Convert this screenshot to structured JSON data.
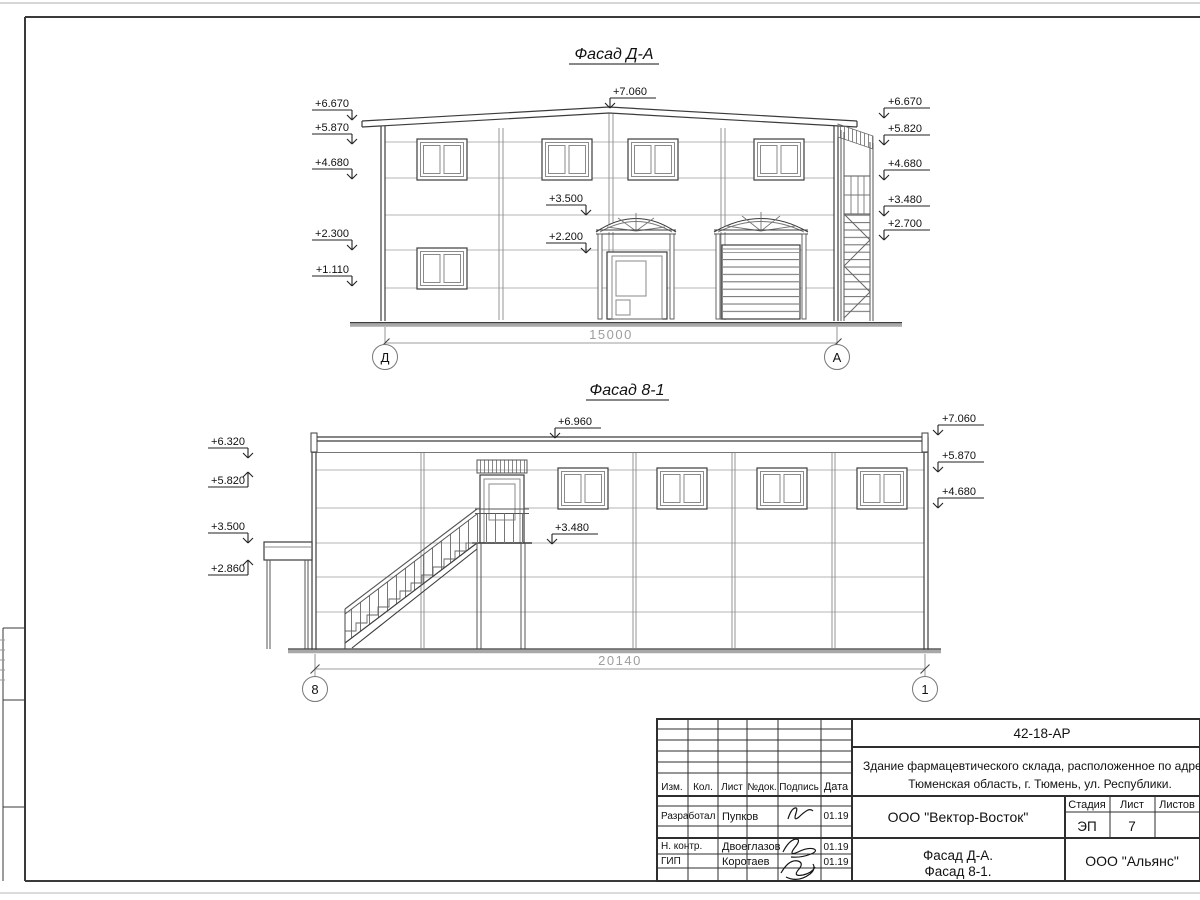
{
  "facade_da": {
    "title": "Фасад Д-А",
    "top_mark": "+7.060",
    "left_marks": [
      "+6.670",
      "+5.870",
      "+4.680",
      "+2.300",
      "+1.110"
    ],
    "mid_marks": [
      "+3.500",
      "+2.200"
    ],
    "right_marks": [
      "+6.670",
      "+5.820",
      "+4.680",
      "+3.480",
      "+2.700"
    ],
    "dimension": "15000",
    "axis_left": "Д",
    "axis_right": "А"
  },
  "facade_81": {
    "title": "Фасад 8-1",
    "top_mark": "+6.960",
    "left_marks": [
      "+6.320",
      "+5.820",
      "+3.500",
      "+2.860"
    ],
    "mid_marks": [
      "+3.480"
    ],
    "right_marks": [
      "+7.060",
      "+5.870",
      "+4.680"
    ],
    "dimension": "20140",
    "axis_left": "8",
    "axis_right": "1"
  },
  "title_block": {
    "doc_number": "42-18-АР",
    "address_line1": "Здание фармацевтического склада, расположенное по адресу:",
    "address_line2": "Тюменская область, г. Тюмень, ул. Республики.",
    "headers": [
      "Изм.",
      "Кол.",
      "Лист",
      "№док.",
      "Подпись",
      "Дата"
    ],
    "rows": [
      {
        "role": "Разработал",
        "name": "Пупков",
        "date": "01.19"
      },
      {
        "role": "Н. контр.",
        "name": "Двоеглазов",
        "date": "01.19"
      },
      {
        "role": "ГИП",
        "name": "Коротаев",
        "date": "01.19"
      }
    ],
    "design_company": "ООО \"Вектор-Восток\"",
    "stage_label": "Стадия",
    "sheet_label": "Лист",
    "sheets_label": "Листов",
    "stage_value": "ЭП",
    "sheet_value": "7",
    "sheets_value": "",
    "drawing_name_line1": "Фасад Д-А.",
    "drawing_name_line2": "Фасад 8-1.",
    "client_company": "ООО \"Альянс\""
  }
}
